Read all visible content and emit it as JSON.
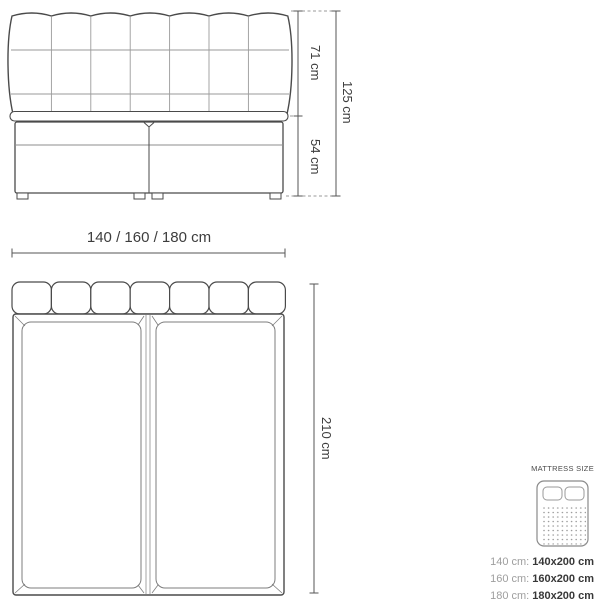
{
  "diagram_title": "bed-dimensions-diagram",
  "front_view": {
    "dim_headboard_height": "71 cm",
    "dim_total_height": "125 cm",
    "dim_base_height": "54 cm",
    "dim_width": "140 / 160 / 180 cm"
  },
  "top_view": {
    "dim_length": "210 cm"
  },
  "legend": {
    "title": "MATTRESS SIZE",
    "rows": [
      {
        "label": "140 cm:",
        "value": "140x200 cm"
      },
      {
        "label": "160 cm:",
        "value": "160x200 cm"
      },
      {
        "label": "180 cm:",
        "value": "180x200 cm"
      }
    ]
  },
  "colors": {
    "outline": "#4a4a4a",
    "grid": "#9a9a9a",
    "dimension": "#555555",
    "text": "#3d3d3d",
    "legend_muted": "#9e9e9e"
  }
}
